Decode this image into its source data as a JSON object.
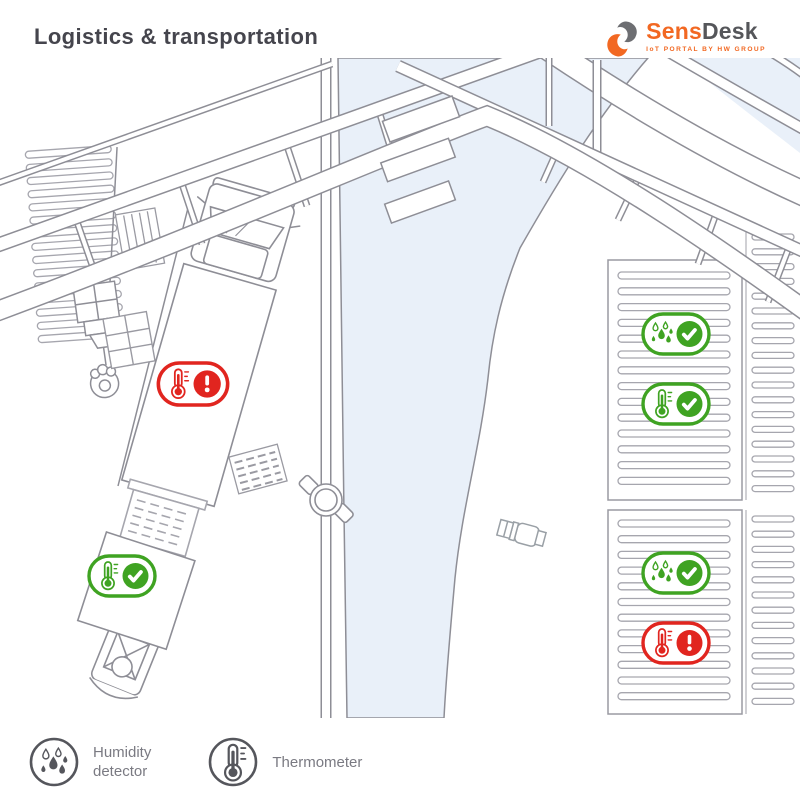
{
  "header": {
    "title": "Logistics & transportation",
    "logo": {
      "brand_primary": "Sens",
      "brand_secondary": "Desk",
      "tagline": "IoT PORTAL BY HW GROUP"
    }
  },
  "colors": {
    "accent_orange": "#f26822",
    "logo_gray": "#6d6e72",
    "status_ok_green": "#3fa322",
    "status_alert_red": "#e1251f",
    "river_blue": "#e9f0f9",
    "line_gray": "#8e8e96",
    "stripe_gray": "#a6a6ae",
    "title_gray": "#45454d",
    "text_gray": "#7a7a82",
    "legend_icon_gray": "#55565c"
  },
  "sensors": [
    {
      "id": "truck-thermometer",
      "type": "thermometer",
      "status": "alert",
      "x": 193,
      "y": 326,
      "scale": 1.05
    },
    {
      "id": "forklift-box-thermometer",
      "type": "thermometer",
      "status": "ok",
      "x": 122,
      "y": 518,
      "scale": 1
    },
    {
      "id": "rack-top-humidity",
      "type": "humidity",
      "status": "ok",
      "x": 676,
      "y": 276,
      "scale": 1
    },
    {
      "id": "rack-top-thermometer",
      "type": "thermometer",
      "status": "ok",
      "x": 676,
      "y": 346,
      "scale": 1
    },
    {
      "id": "rack-bottom-humidity",
      "type": "humidity",
      "status": "ok",
      "x": 676,
      "y": 515,
      "scale": 1
    },
    {
      "id": "rack-bottom-thermometer",
      "type": "thermometer",
      "status": "alert",
      "x": 676,
      "y": 585,
      "scale": 1
    }
  ],
  "legend": {
    "items": [
      {
        "icon": "humidity-detector-icon",
        "label": "Humidity detector",
        "lines": [
          "Humidity",
          "detector"
        ]
      },
      {
        "icon": "thermometer-icon",
        "label": "Thermometer",
        "lines": [
          "Thermometer"
        ]
      }
    ]
  }
}
